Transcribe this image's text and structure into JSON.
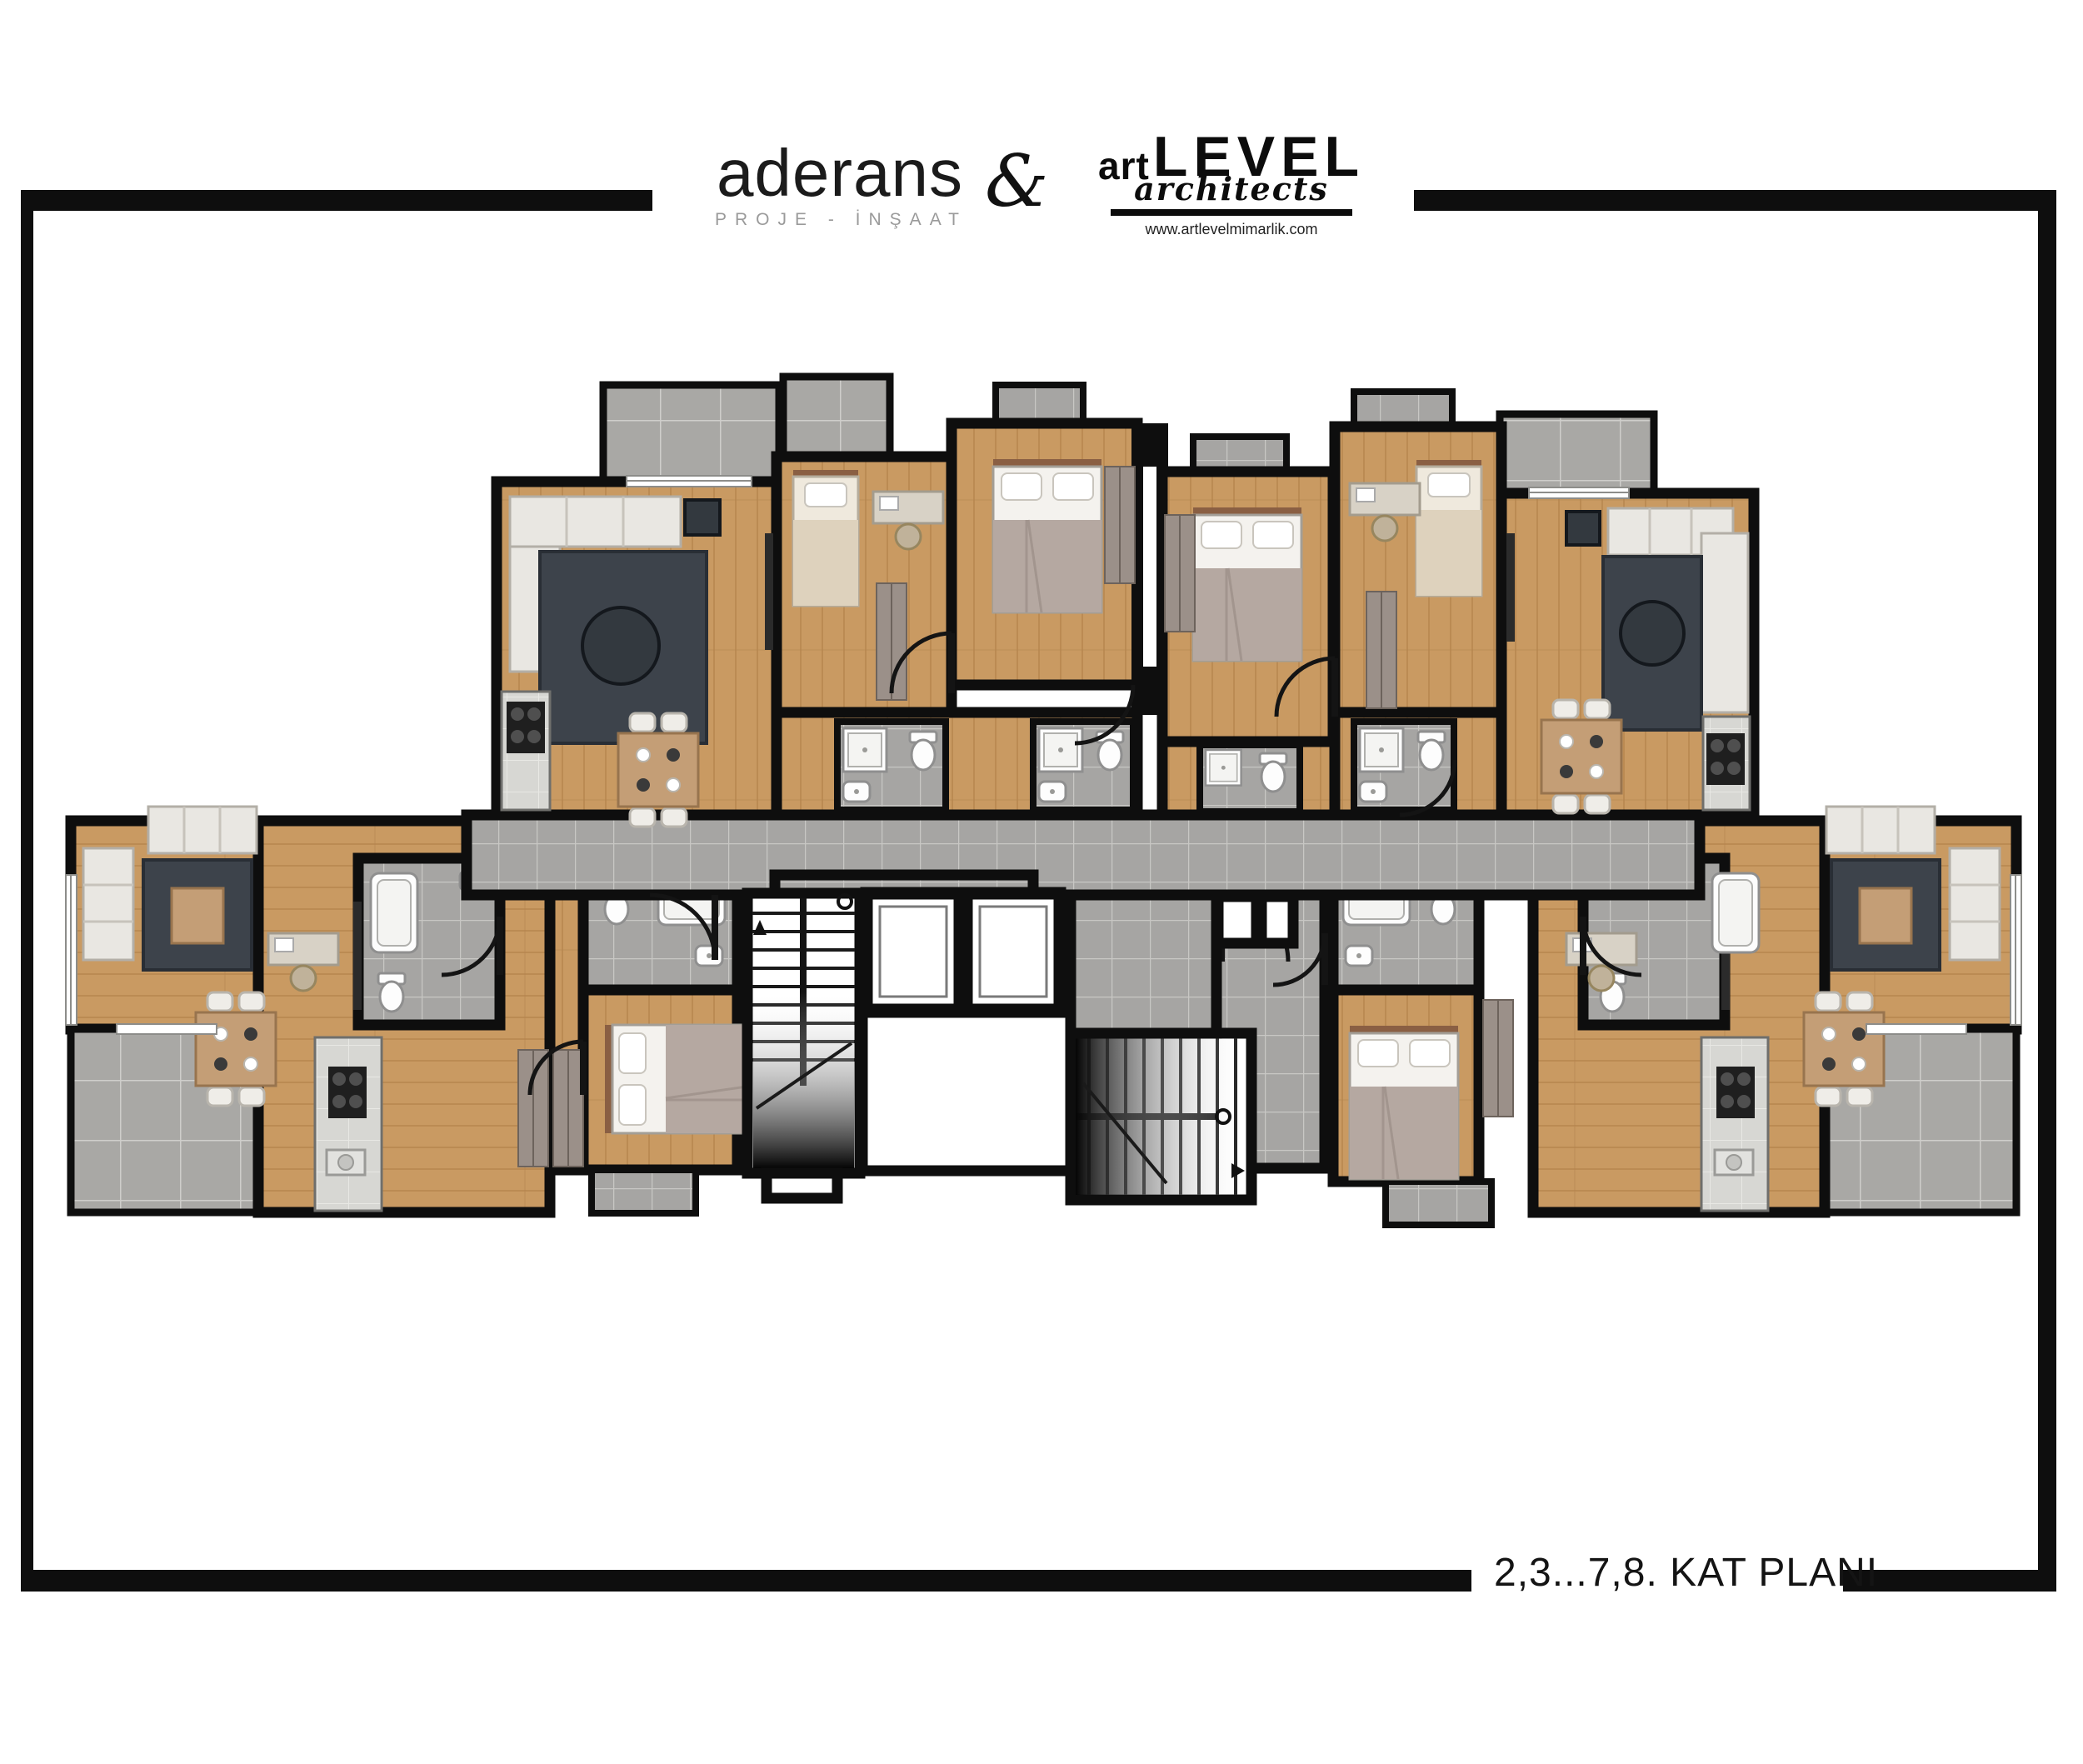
{
  "header": {
    "brand_left": {
      "name": "aderans",
      "tagline": "PROJE - İNŞAAT"
    },
    "separator": "&",
    "brand_right": {
      "prefix": "art",
      "name": "LEVEL",
      "suffix": "architects",
      "website": "www.artlevelmimarlik.com"
    }
  },
  "title_block": {
    "floor_label": "2,3...7,8. KAT PLANI"
  },
  "plan": {
    "colors": {
      "wall": "#0e0e0e",
      "wood": "#c99a62",
      "wood_line": "#b5854d",
      "tile": "#a6a5a3",
      "tile_line": "#c8c7c4",
      "marble": "#d7d7d3",
      "marble_line": "#e8e8e4",
      "rug": "#3d434b",
      "sofa": "#e9e7e2",
      "bed": "#f4f2ee",
      "blanket": "#b5a8a1",
      "furniture_wood": "#c49e76"
    }
  }
}
